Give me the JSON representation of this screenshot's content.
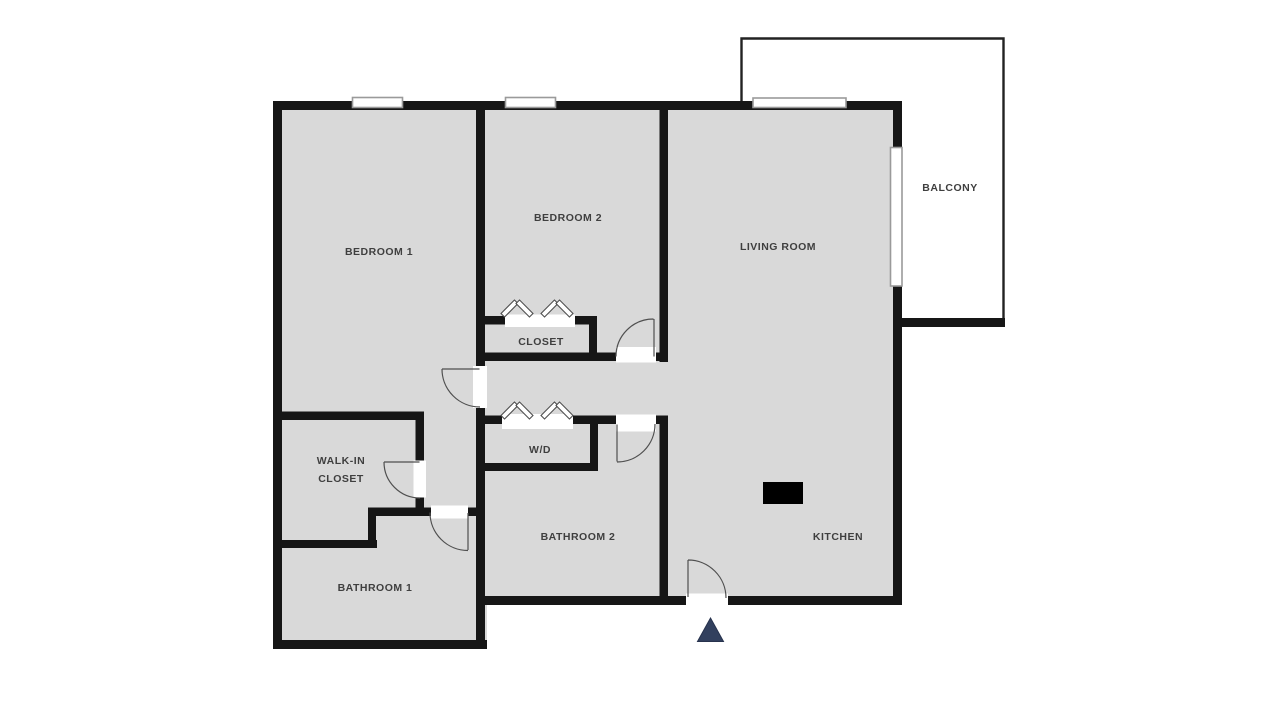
{
  "plan": {
    "type": "apartment-floor-plan",
    "rooms": [
      {
        "id": "bedroom-1",
        "label": "BEDROOM 1"
      },
      {
        "id": "bedroom-2",
        "label": "BEDROOM 2"
      },
      {
        "id": "living-room",
        "label": "LIVING ROOM"
      },
      {
        "id": "balcony",
        "label": "BALCONY"
      },
      {
        "id": "closet",
        "label": "CLOSET"
      },
      {
        "id": "walk-in-closet",
        "label": "WALK-IN CLOSET"
      },
      {
        "id": "washer-dryer",
        "label": "W/D"
      },
      {
        "id": "bathroom-1",
        "label": "BATHROOM 1"
      },
      {
        "id": "bathroom-2",
        "label": "BATHROOM 2"
      },
      {
        "id": "kitchen",
        "label": "KITCHEN"
      }
    ],
    "icons": [
      {
        "name": "entrance-marker-icon",
        "shape": "triangle-up"
      },
      {
        "name": "kitchen-fixture",
        "shape": "black-rectangle"
      },
      {
        "name": "bifold-door-icon",
        "count": 4
      },
      {
        "name": "door-swing-arc",
        "count": 6
      },
      {
        "name": "window",
        "count": 4
      }
    ]
  },
  "colors": {
    "background": "#ffffff",
    "floor": "#d9d9d9",
    "wall": "#161616",
    "door_arc": "#4f4f4f",
    "window_border": "#9a9a9a",
    "entrance_marker": "#32405e",
    "fixture": "#000000",
    "label_text": "#3f3f3f"
  }
}
